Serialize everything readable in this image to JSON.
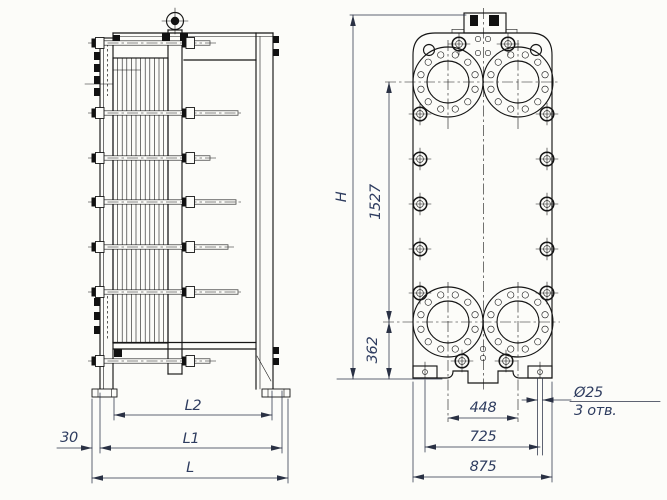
{
  "colors": {
    "background": "#fcfcf9",
    "drawing_line": "#161616",
    "dimension_text": "#2e3c5f"
  },
  "side_view": {
    "dim_l2": "L2",
    "dim_l1": "L1",
    "dim_l": "L",
    "dim_offset": "30"
  },
  "front_view": {
    "dim_height": "H",
    "dim_port_top_to_bottom": "1527",
    "dim_port_to_base": "362",
    "dim_port_spacing": "448",
    "dim_foot_hole_spacing": "725",
    "dim_plate_width": "875",
    "hole_diameter": "Ø25",
    "hole_count": "3 отв."
  }
}
